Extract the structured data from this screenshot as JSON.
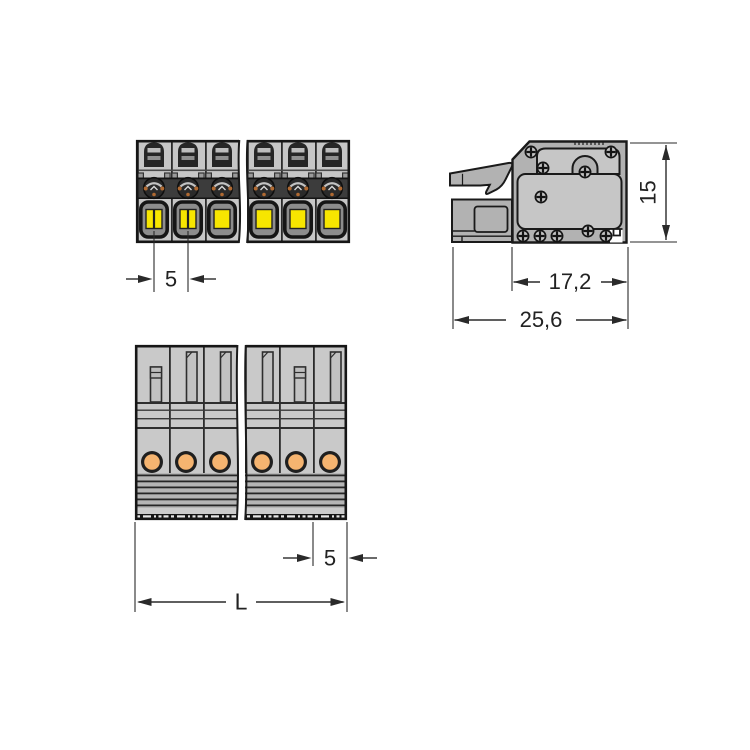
{
  "dimensions": {
    "front_pitch": "5",
    "side_height": "15",
    "side_depth_housing": "17,2",
    "side_depth_total": "25,6",
    "bottom_pitch": "5",
    "bottom_length": "L"
  },
  "colors": {
    "background": "#ffffff",
    "outline": "#1a1a1a",
    "dimension_line": "#2a2a2a",
    "body_gray": "#c6c6c6",
    "body_gray_dark": "#b2b2b2",
    "band_dark": "#3c3c3c",
    "button_yellow": "#f7e600",
    "conductor_orange": "#f5b470",
    "contact_copper": "#b06a32"
  }
}
